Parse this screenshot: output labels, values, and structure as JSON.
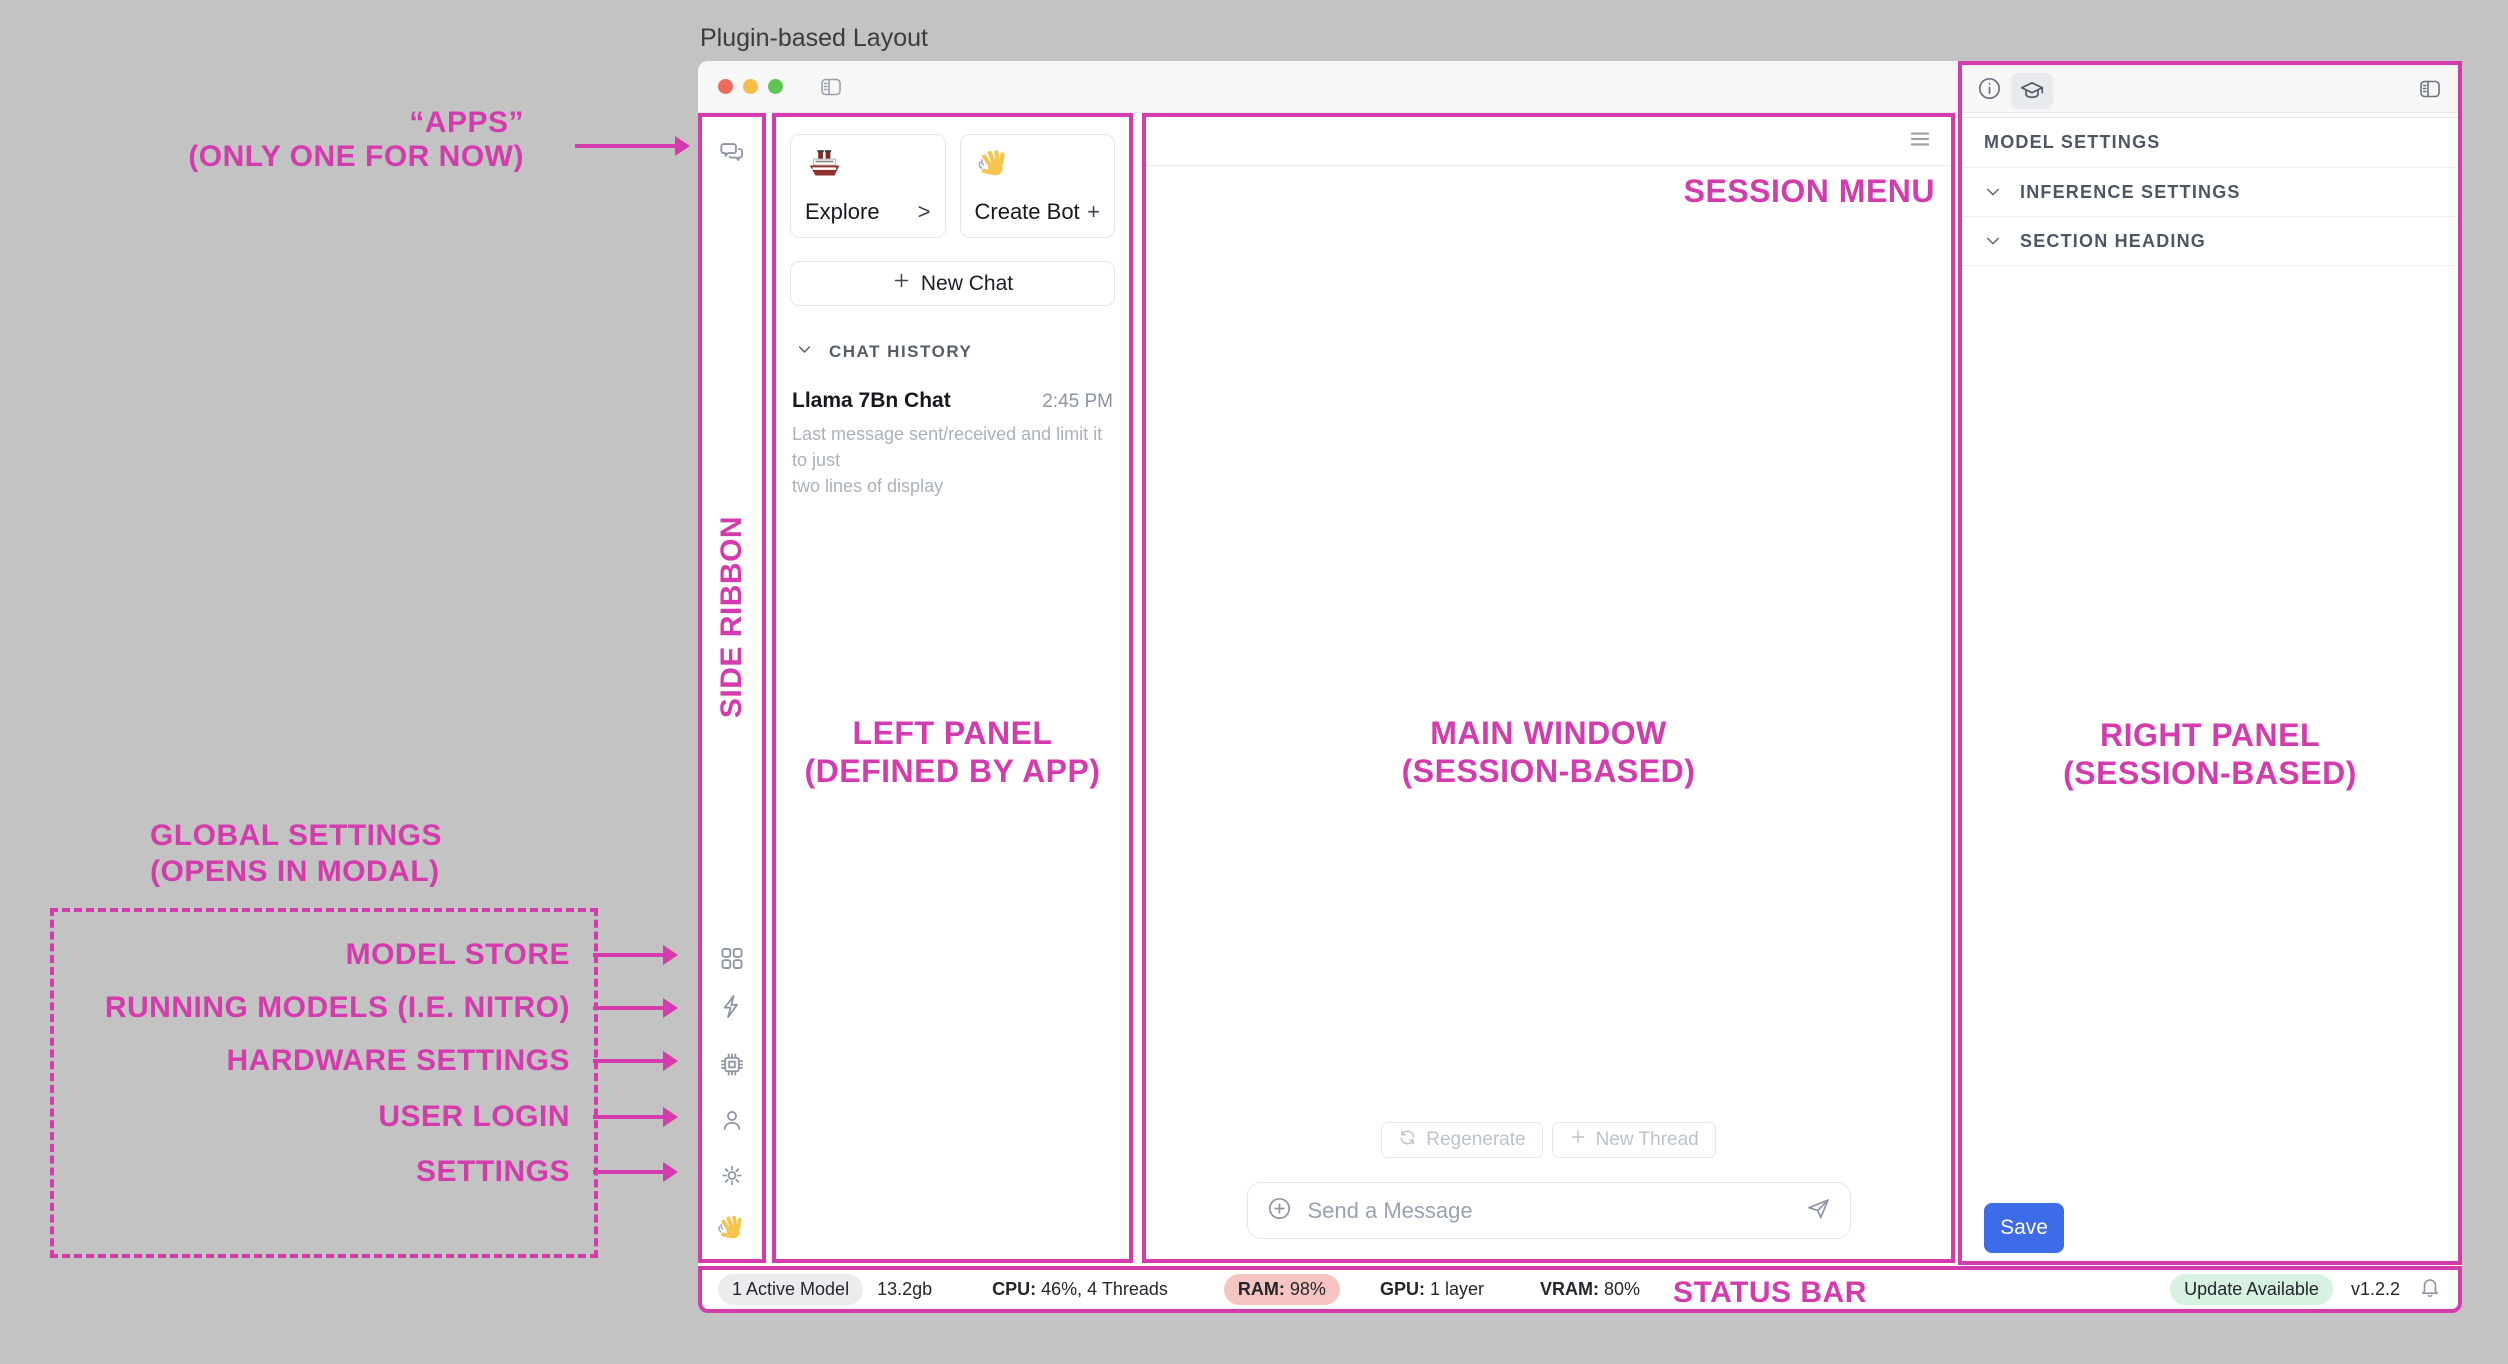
{
  "title": "Plugin-based Layout",
  "colors": {
    "annotation_accent": "#d43bac",
    "save_button": "#3e6be8",
    "ram_badge_bg": "#f6c5c2",
    "update_badge_bg": "#d8f2e2",
    "active_model_pill_bg": "#ececee",
    "traffic_lights": [
      "#ee6a5f",
      "#f5bd4c",
      "#5ec454"
    ]
  },
  "annotations": {
    "apps_line1": "“APPS”",
    "apps_line2": "(ONLY ONE FOR NOW)",
    "side_ribbon": "SIDE RIBBON",
    "left_panel_line1": "LEFT PANEL",
    "left_panel_line2": "(DEFINED BY APP)",
    "main_window_line1": "MAIN WINDOW",
    "main_window_line2": "(SESSION-BASED)",
    "right_panel_line1": "RIGHT PANEL",
    "right_panel_line2": "(SESSION-BASED)",
    "session_menu": "SESSION MENU",
    "status_bar": "STATUS BAR",
    "global_settings_line1": "GLOBAL SETTINGS",
    "global_settings_line2": "(OPENS IN MODAL)",
    "global_items": [
      {
        "label": "MODEL STORE"
      },
      {
        "label": "RUNNING MODELS (I.E. NITRO)"
      },
      {
        "label": "HARDWARE SETTINGS"
      },
      {
        "label": "USER LOGIN"
      },
      {
        "label": "SETTINGS"
      }
    ]
  },
  "side_ribbon": {
    "icons": [
      "chat-bubbles-icon",
      "grid-icon",
      "lightning-icon",
      "cpu-chip-icon",
      "user-icon",
      "gear-icon",
      "wave-hand-icon"
    ]
  },
  "left_panel": {
    "explore_card": {
      "icon": "ship-icon",
      "label": "Explore",
      "affordance": ">"
    },
    "create_bot_card": {
      "icon": "wave-hand-icon",
      "label": "Create Bot",
      "affordance": "+"
    },
    "new_chat_label": "New Chat",
    "chat_history_header": "CHAT HISTORY",
    "chat_item": {
      "title": "Llama 7Bn Chat",
      "time": "2:45 PM",
      "preview_line1": "Last message sent/received and limit it to just",
      "preview_line2": "two lines of display"
    }
  },
  "main": {
    "regenerate_label": "Regenerate",
    "new_thread_label": "New Thread",
    "send_placeholder": "Send a Message"
  },
  "right_panel": {
    "model_settings_header": "MODEL SETTINGS",
    "inference_settings": "INFERENCE SETTINGS",
    "section_heading": "SECTION HEADING",
    "save_label": "Save"
  },
  "status_bar": {
    "active_model": "1 Active Model",
    "size": "13.2gb",
    "cpu_label": "CPU:",
    "cpu_value": "46%, 4 Threads",
    "ram_label": "RAM:",
    "ram_value": "98%",
    "gpu_label": "GPU:",
    "gpu_value": "1 layer",
    "vram_label": "VRAM:",
    "vram_value": "80%",
    "update_badge": "Update Available",
    "version": "v1.2.2"
  }
}
